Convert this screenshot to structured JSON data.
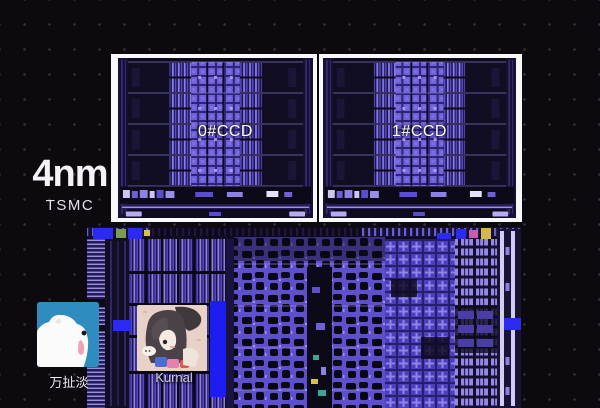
{
  "annotation": {
    "node_label": "4nm",
    "foundry_label": "TSMC",
    "ccd0_label": "0#CCD",
    "ccd1_label": "1#CCD"
  },
  "watermark": {
    "uploader_name": "万扯淡",
    "author_name": "Kurnal"
  },
  "icons": {
    "bear_avatar": "polar-bear-avatar",
    "kurnal_avatar": "anime-girl-avatar"
  },
  "colors": {
    "background": "#0c0a0f",
    "frame_white": "#f8f8f8",
    "die_dark": "#0b0816",
    "die_purple": "#5e50cc",
    "die_purple_bright": "#9187e8",
    "cache_purple": "#6e60d6",
    "accent_blue": "#1d1df2",
    "bear_avatar_bg": "#2f8cbf",
    "label_text": "#f5f3f8"
  }
}
